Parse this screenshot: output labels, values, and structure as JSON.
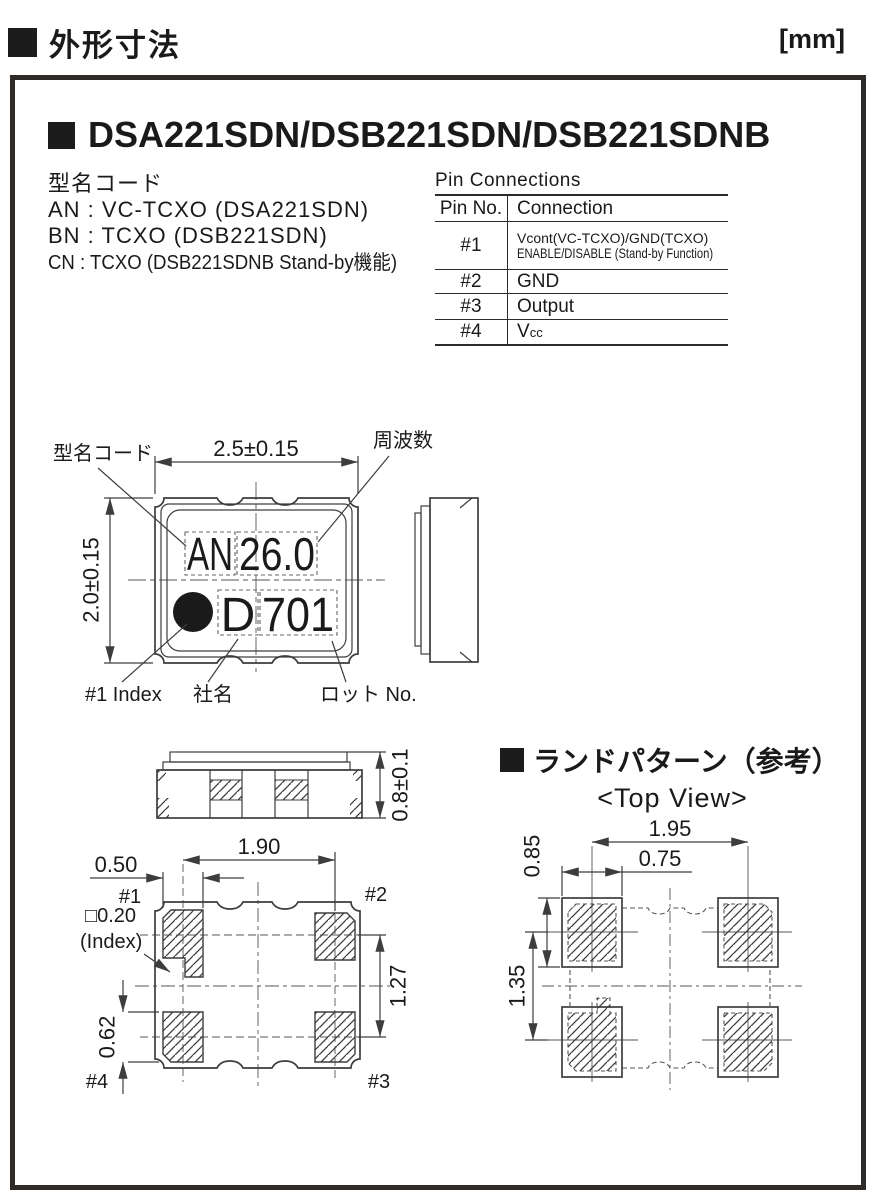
{
  "colors": {
    "ink": "#1a1a1a",
    "line": "#3d3d3d"
  },
  "header": {
    "section_title": "外形寸法",
    "unit": "[mm]"
  },
  "title": "DSA221SDN/DSB221SDN/DSB221SDNB",
  "model_code": {
    "heading": "型名コード",
    "line_an": "AN : VC-TCXO (DSA221SDN)",
    "line_bn": "BN : TCXO (DSB221SDN)",
    "line_cn": "CN : TCXO (DSB221SDNB Stand-by機能)"
  },
  "pin_connections": {
    "title": "Pin Connections",
    "columns": {
      "pin": "Pin No.",
      "connection": "Connection"
    },
    "rows": [
      {
        "pin": "#1",
        "line1": "Vcont(VC-TCXO)/GND(TCXO)",
        "line2": "ENABLE/DISABLE (Stand-by Function)"
      },
      {
        "pin": "#2",
        "line1": "GND"
      },
      {
        "pin": "#3",
        "line1": "Output"
      },
      {
        "pin": "#4",
        "line1": "V",
        "sub": "cc"
      }
    ]
  },
  "top_view": {
    "label_model_code": "型名コード",
    "label_frequency": "周波数",
    "dim_width": "2.5±0.15",
    "dim_height": "2.0±0.15",
    "marking": {
      "model": "AN",
      "frequency": "26.0",
      "company": "D",
      "lot": "701"
    },
    "label_index": "#1 Index",
    "label_company": "社名",
    "label_lot": "ロット No."
  },
  "side_view": {
    "dim_thickness": "0.8±0.1"
  },
  "bottom_view": {
    "dim_pad_pitch_x": "1.90",
    "dim_pad_width": "0.50",
    "dim_pad_height": "0.62",
    "dim_pad_pitch_y": "1.27",
    "index_size": "□0.20",
    "index_label": "(Index)",
    "pin1": "#1",
    "pin2": "#2",
    "pin3": "#3",
    "pin4": "#4"
  },
  "land_pattern": {
    "heading": "ランドパターン（参考）",
    "subtitle": "<Top View>",
    "dim_pitch_x": "1.95",
    "dim_land_width": "0.75",
    "dim_land_height": "0.85",
    "dim_pitch_y": "1.35"
  }
}
